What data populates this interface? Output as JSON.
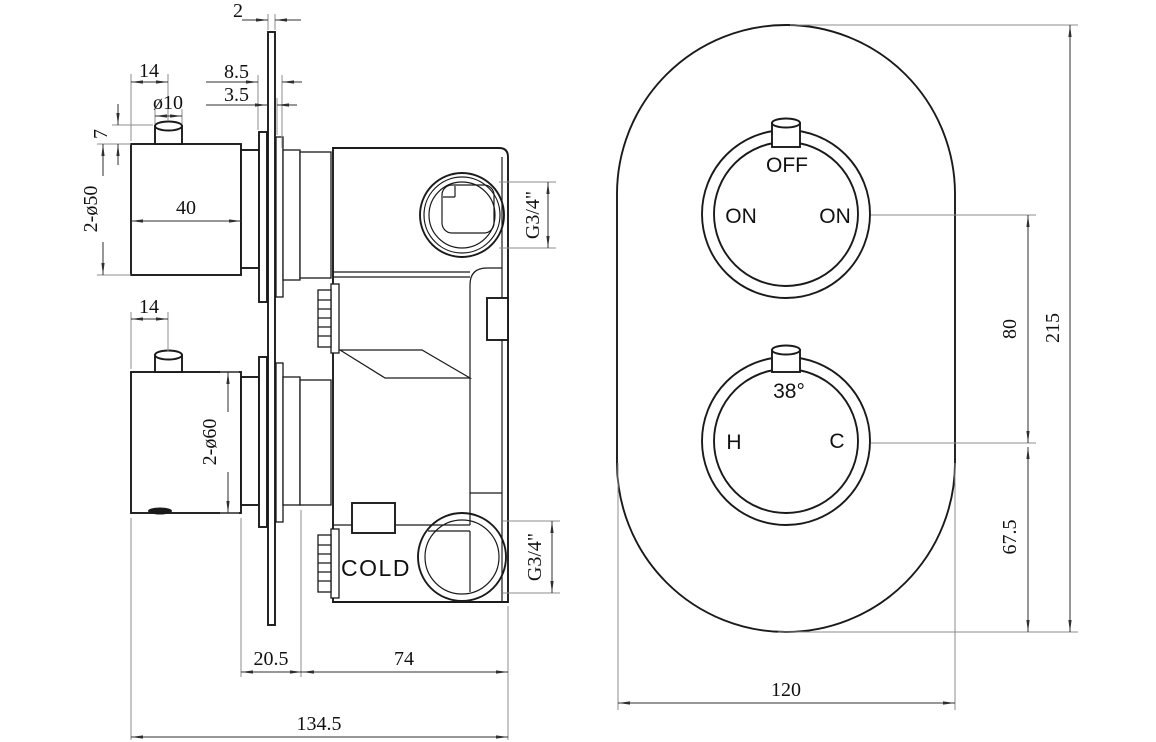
{
  "sv": {
    "d2": "2",
    "d14_top": "14",
    "d8_5": "8.5",
    "d3_5": "3.5",
    "d_btn": "ø10",
    "d7": "7",
    "d_knob_top": "2-ø50",
    "d40": "40",
    "d14_bot": "14",
    "d_knob_bot": "2-ø60",
    "g34_top": "G3/4\"",
    "g34_bot": "G3/4\"",
    "cold_label": "COLD",
    "d20_5": "20.5",
    "d74": "74",
    "d134_5": "134.5"
  },
  "fv": {
    "off": "OFF",
    "on_left": "ON",
    "on_right": "ON",
    "temp": "38°",
    "hot": "H",
    "cold": "C",
    "d80": "80",
    "d215": "215",
    "d67_5": "67.5",
    "d120": "120"
  },
  "colors": {
    "line": "#1a1a1a",
    "dim": "#2f2f2f",
    "ext": "#8d8d8d",
    "bg": "#ffffff"
  }
}
